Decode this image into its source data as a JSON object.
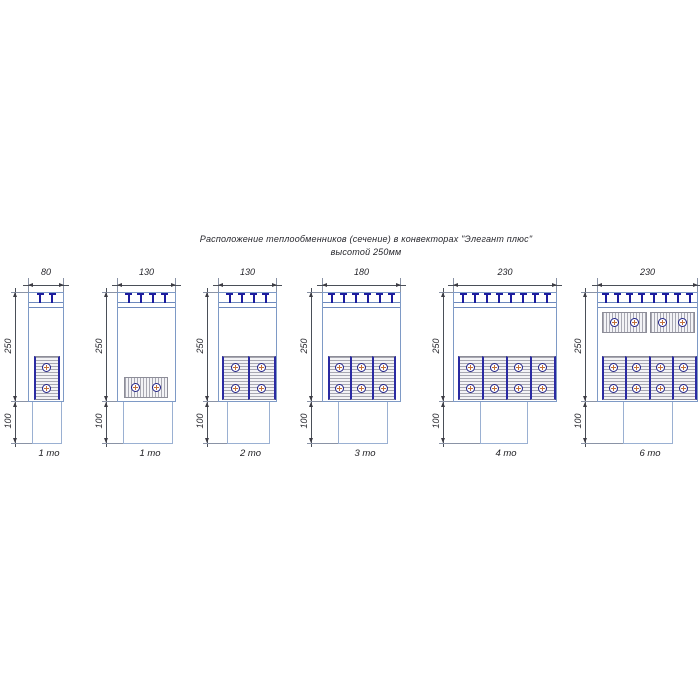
{
  "title": {
    "line1": "Расположение теплообменников (сечение) в конвекторах \"Элегант плюс\"",
    "line2": "высотой 250мм"
  },
  "dimensions": {
    "body_height_mm": "250",
    "duct_height_mm": "100"
  },
  "colors": {
    "outline_blue": "#7e9ac6",
    "duct_blue": "#9ab0d2",
    "clip_navy": "#1c1c9e",
    "divider_navy": "#2a2aa2",
    "circle_navy": "#232388",
    "tube_cross_orange": "#c2703a",
    "hatch_gray": "#a8a8b2",
    "dim_gray": "#4a4f58"
  },
  "layout": {
    "body_top": 292,
    "band_line1": 302,
    "band_line2": 307,
    "body_bottom": 401,
    "duct_bottom": 443,
    "dim_line_y": 285,
    "ext_top": 278,
    "width_text_y": 267,
    "label_y": 448,
    "clip_pitch": 12
  },
  "diagrams": [
    {
      "label": "1 то",
      "width_mm": "80",
      "dim_x": 15,
      "box": {
        "x": 28,
        "w": 36
      },
      "duct": {
        "x": 32,
        "w": 30
      },
      "clips": 2,
      "groups": [
        {
          "type": "v",
          "x": 34,
          "w": 24,
          "y": 356,
          "h": 44,
          "units": 1
        }
      ]
    },
    {
      "label": "1 то",
      "width_mm": "130",
      "dim_x": 106,
      "box": {
        "x": 117,
        "w": 59
      },
      "duct": {
        "x": 123,
        "w": 50
      },
      "clips": 4,
      "groups": [
        {
          "type": "h",
          "x": 124,
          "w": 44,
          "y": 377,
          "h": 21,
          "units": 1
        }
      ]
    },
    {
      "label": "2 то",
      "width_mm": "130",
      "dim_x": 207,
      "box": {
        "x": 218,
        "w": 59
      },
      "duct": {
        "x": 227,
        "w": 43
      },
      "clips": 4,
      "groups": [
        {
          "type": "v",
          "x": 222,
          "w": 52,
          "y": 356,
          "h": 44,
          "units": 2
        }
      ]
    },
    {
      "label": "3 то",
      "width_mm": "180",
      "dim_x": 311,
      "box": {
        "x": 322,
        "w": 79
      },
      "duct": {
        "x": 338,
        "w": 50
      },
      "clips": 6,
      "groups": [
        {
          "type": "v",
          "x": 328,
          "w": 66,
          "y": 356,
          "h": 44,
          "units": 3
        }
      ]
    },
    {
      "label": "4 то",
      "width_mm": "230",
      "dim_x": 443,
      "box": {
        "x": 453,
        "w": 104
      },
      "duct": {
        "x": 480,
        "w": 48
      },
      "clips": 8,
      "groups": [
        {
          "type": "v",
          "x": 458,
          "w": 96,
          "y": 356,
          "h": 44,
          "units": 4
        }
      ]
    },
    {
      "label": "6 то",
      "width_mm": "230",
      "dim_x": 585,
      "box": {
        "x": 597,
        "w": 101
      },
      "duct": {
        "x": 623,
        "w": 50
      },
      "clips": 8,
      "groups": [
        {
          "type": "h",
          "x": 602,
          "w": 45,
          "y": 312,
          "h": 21,
          "units": 1
        },
        {
          "type": "h",
          "x": 650,
          "w": 45,
          "y": 312,
          "h": 21,
          "units": 1
        },
        {
          "type": "v",
          "x": 602,
          "w": 93,
          "y": 356,
          "h": 44,
          "units": 4
        }
      ]
    }
  ]
}
